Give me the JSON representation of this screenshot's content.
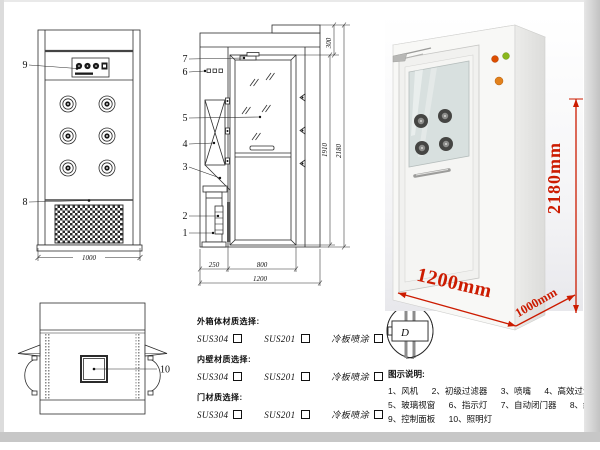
{
  "drawing": {
    "front_view": {
      "part_labels": {
        "control_panel": "9",
        "grille": "8"
      },
      "width_dim": "1000"
    },
    "side_view": {
      "part_labels": [
        "7",
        "6",
        "5",
        "4",
        "3",
        "2",
        "1"
      ],
      "dims": {
        "top": "300",
        "door_height": "1910",
        "total_height": "2180",
        "depth": "250",
        "door_width": "800",
        "total_width": "1200"
      }
    },
    "top_view": {
      "part_labels": {
        "lamp": "10"
      }
    }
  },
  "photo": {
    "height_label": "2180mm",
    "width_label": "1200mm",
    "depth_label": "1000mm",
    "dim_color": "#cc1b00"
  },
  "materials": {
    "sections": [
      {
        "title": "外箱体材质选择:",
        "options": [
          {
            "label": "SUS304"
          },
          {
            "label": "SUS201"
          },
          {
            "label": "冷板喷涂"
          }
        ]
      },
      {
        "title": "内壁材质选择:",
        "options": [
          {
            "label": "SUS304"
          },
          {
            "label": "SUS201"
          },
          {
            "label": "冷板喷涂"
          }
        ]
      },
      {
        "title": "门材质选择:",
        "options": [
          {
            "label": "SUS304"
          },
          {
            "label": "SUS201"
          },
          {
            "label": "冷板喷涂"
          }
        ]
      }
    ]
  },
  "door_options": {
    "labels": [
      "A",
      "B",
      "C",
      "D"
    ]
  },
  "legend": {
    "title": "图示说明:",
    "items": [
      "1、风机",
      "2、初级过滤器",
      "3、喷嘴",
      "4、高效过滤器",
      "5、玻璃视窗",
      "6、指示灯",
      "7、自动闭门器",
      "8、红外线感应器",
      "9、控制面板",
      "10、照明灯"
    ]
  }
}
